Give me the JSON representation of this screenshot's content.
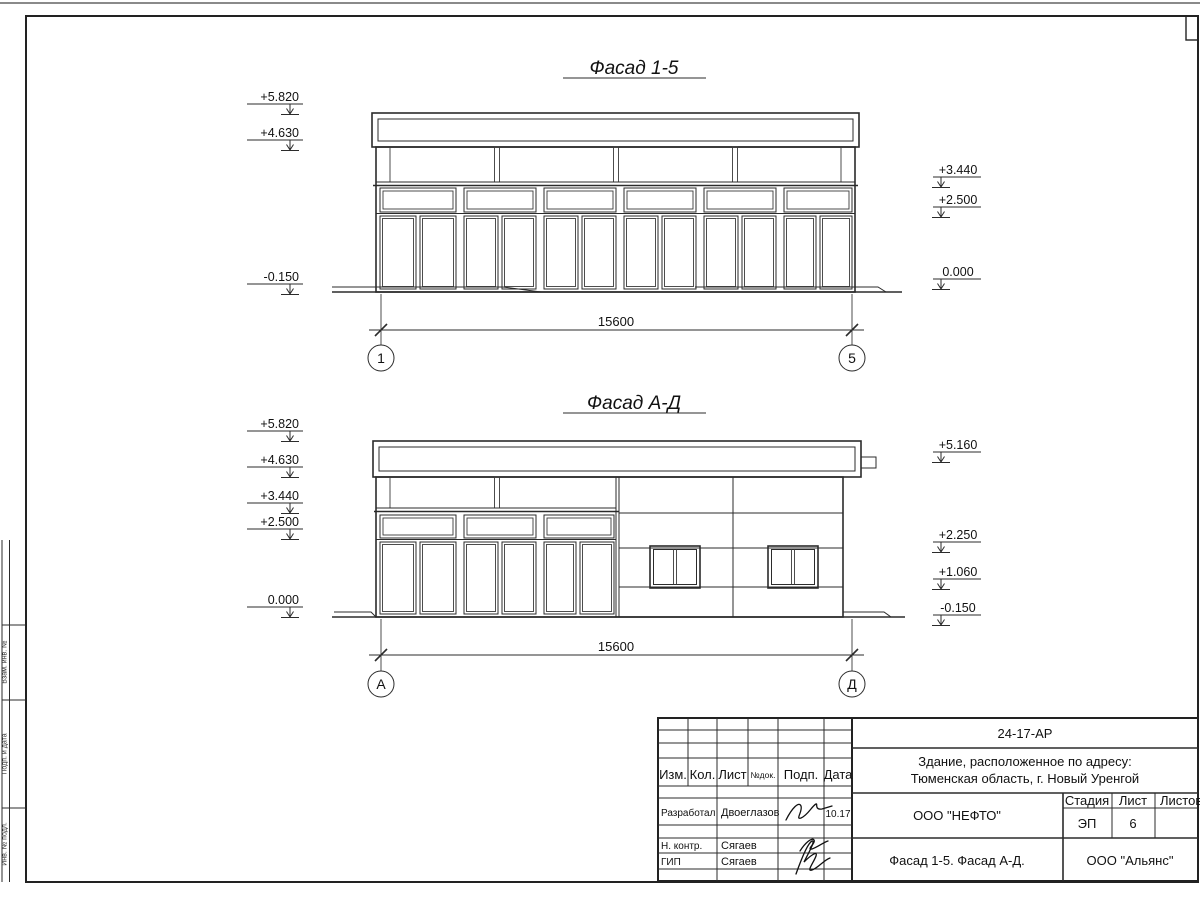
{
  "colors": {
    "line": "#2b2b2b",
    "text": "#111111",
    "background": "#ffffff"
  },
  "titles": {
    "facade1": "Фасад 1-5",
    "facade2": "Фасад А-Д"
  },
  "facade1": {
    "marks_left": [
      "+5.820",
      "+4.630",
      "-0.150"
    ],
    "marks_right": [
      "+3.440",
      "+2.500",
      "0.000"
    ],
    "dim": "15600",
    "axes": [
      "1",
      "5"
    ]
  },
  "facade2": {
    "marks_left": [
      "+5.820",
      "+4.630",
      "+3.440",
      "+2.500",
      "0.000"
    ],
    "marks_right": [
      "+5.160",
      "+2.250",
      "+1.060",
      "-0.150"
    ],
    "dim": "15600",
    "axes": [
      "А",
      "Д"
    ]
  },
  "titleblock": {
    "doc_number": "24-17-АР",
    "project_line1": "Здание, расположенное по адресу:",
    "project_line2": "Тюменская область, г. Новый Уренгой",
    "client": "ООО \"НЕФТО\"",
    "stage_label": "Стадия",
    "sheet_label": "Лист",
    "sheets_label": "Листов",
    "stage": "ЭП",
    "sheet": "6",
    "sheets": "",
    "drawing_title": "Фасад 1-5. Фасад А-Д.",
    "org": "ООО \"Альянс\"",
    "rev_headers": [
      "Изм.",
      "Кол.",
      "Лист",
      "№док.",
      "Подп.",
      "Дата"
    ],
    "roles": [
      {
        "role": "Разработал",
        "name": "Двоеглазов",
        "date": "10.17"
      },
      {
        "role": "Н. контр.",
        "name": "Сягаев",
        "date": ""
      },
      {
        "role": "ГИП",
        "name": "Сягаев",
        "date": ""
      }
    ]
  },
  "margin": {
    "labels": [
      "Взам. инв. №",
      "Подп. и дата",
      "Инв. № подл."
    ]
  }
}
